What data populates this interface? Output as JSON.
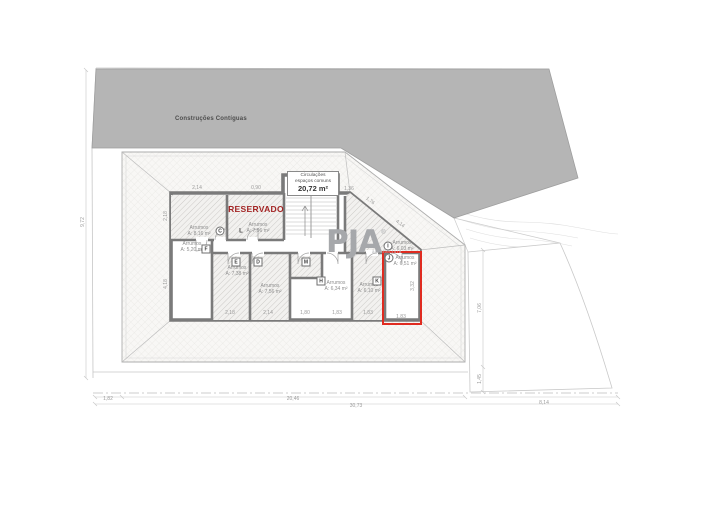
{
  "site": {
    "adjacent_buildings_label": "Construções Contíguas"
  },
  "logo": {
    "text": "PJA",
    "registered": "®",
    "subtext": "arquitectura"
  },
  "circulation": {
    "line1": "Circulações",
    "line2": "espaços comuns",
    "area": "20,72 m²"
  },
  "reserved_label": "RESERVADO",
  "highlight_color": "#e02b20",
  "reserved_color": "#a32424",
  "rooms": [
    {
      "letter": "C",
      "marker": "circle",
      "name": "Arrumos",
      "area": "A: 8,16 m²"
    },
    {
      "letter": "L",
      "marker": "plain",
      "name": "Arrumos",
      "area": "A: 7,96 m²"
    },
    {
      "letter": "F",
      "marker": "box",
      "name": "Arrumos",
      "area": "A: 5,20 m²"
    },
    {
      "letter": "E",
      "marker": "box",
      "name": "Arrumos",
      "area": "A: 7,38 m²"
    },
    {
      "letter": "D",
      "marker": "box",
      "name": "Arrumos",
      "area": "A: 7,56 m²"
    },
    {
      "letter": "M",
      "marker": "box"
    },
    {
      "letter": "H",
      "marker": "box",
      "name": "Arrumos",
      "area": "A: 6,34 m²"
    },
    {
      "letter": "K",
      "marker": "box",
      "name": "Arrumos",
      "area": "A: 6,10 m²"
    },
    {
      "letter": "I",
      "marker": "circle",
      "name": "Arrumos",
      "area": "A: 6,03 m²"
    },
    {
      "letter": "J",
      "marker": "circle",
      "name": "Arrumos",
      "area": "A: 6,51 m²"
    }
  ],
  "dims": [
    "2,14",
    "0,90",
    "1,36",
    "1,76",
    "4,14",
    "2,18",
    "4,18",
    "2,18",
    "2,14",
    "1,80",
    "1,83",
    "1,83",
    "1,83",
    "3,32",
    "1,82",
    "20,46",
    "30,73",
    "8,14",
    "9,72",
    "7,06",
    "1,45"
  ]
}
